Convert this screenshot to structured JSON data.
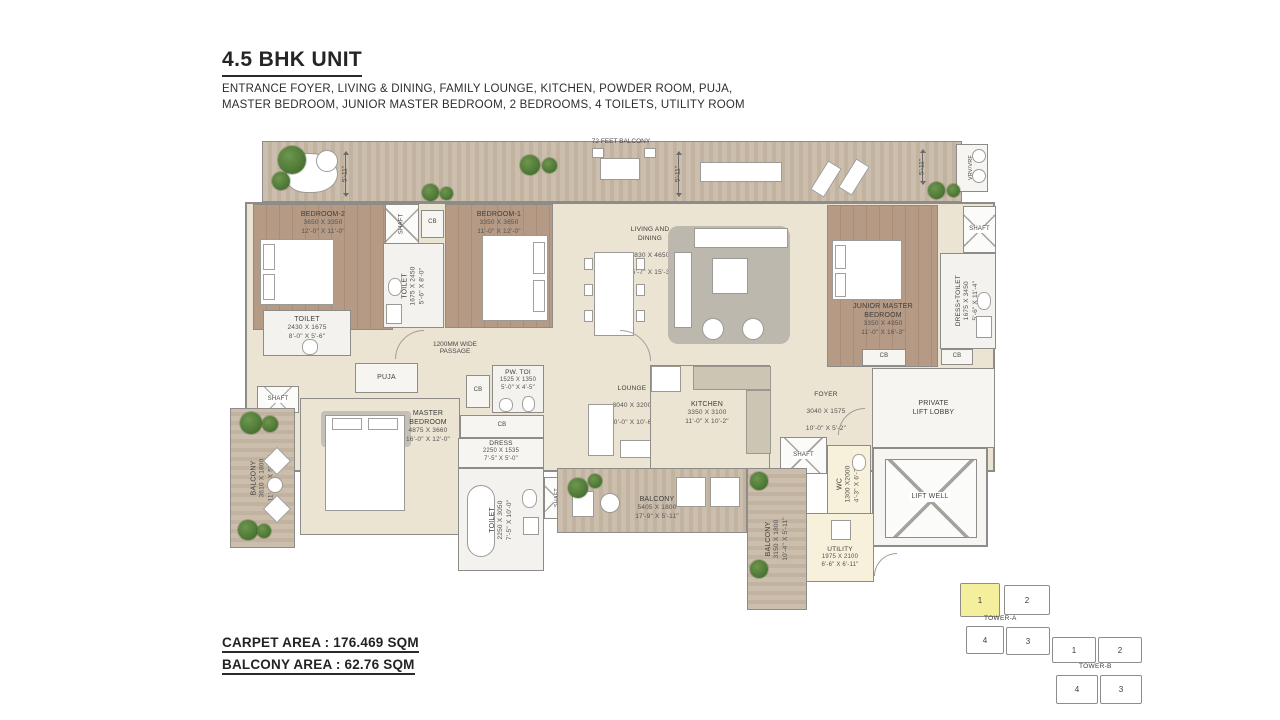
{
  "header": {
    "title": "4.5 BHK UNIT",
    "subtitle": "ENTRANCE FOYER, LIVING & DINING, FAMILY LOUNGE, KITCHEN, POWDER ROOM, PUJA,\nMASTER BEDROOM, JUNIOR MASTER BEDROOM, 2 BEDROOMS, 4 TOILETS, UTILITY ROOM"
  },
  "areas": {
    "carpet_label": "CARPET AREA : 176.469 SQM",
    "balcony_label": "BALCONY AREA : 62.76 SQM"
  },
  "plan": {
    "labels": {
      "shaft": "SHAFT",
      "cb": "CB",
      "puja": "PUJA",
      "vrv": "VRV/VRF",
      "lift_well": "LIFT WELL",
      "private_lift_lobby": "PRIVATE\nLIFT LOBBY",
      "balcony_72": "72 FEET BALCONY",
      "passage": "1200MM WIDE\nPASSAGE",
      "dim_5_11": "5'-11\""
    },
    "rooms": {
      "bedroom2": {
        "name": "BEDROOM-2",
        "mm": "3650 X 3350",
        "ft": "12'-0\" X 11'-0\""
      },
      "bedroom1": {
        "name": "BEDROOM-1",
        "mm": "3350 X 3650",
        "ft": "11'-0\" X 12'-0\""
      },
      "toilet_mid": {
        "name": "TOILET",
        "mm": "1675 X 2450",
        "ft": "5'-6\" X 8'-0\""
      },
      "toilet_left": {
        "name": "TOILET",
        "mm": "2430 X 1675",
        "ft": "8'-0\" X 5'-6\""
      },
      "living_dining": {
        "name": "LIVING AND\nDINING",
        "mm": "7830 X 4650",
        "ft": "25'-7\" X 15'-3\""
      },
      "junior_master": {
        "name": "JUNIOR MASTER\nBEDROOM",
        "mm": "3350 X 4950",
        "ft": "11'-0\" X 16'-3\""
      },
      "dress_toilet": {
        "name": "DRESS+TOILET",
        "mm": "1675 X 3450",
        "ft": "5'-6\" X 11'-4\""
      },
      "master": {
        "name": "MASTER\nBEDROOM",
        "mm": "4875 X 3660",
        "ft": "16'-0\" X 12'-0\""
      },
      "pw_toi": {
        "name": "PW. TOI",
        "mm": "1525 X 1350",
        "ft": "5'-0\" X 4'-5\""
      },
      "dress": {
        "name": "DRESS",
        "mm": "2250 X 1535",
        "ft": "7'-5\" X 5'-0\""
      },
      "toilet_master": {
        "name": "TOILET",
        "mm": "2250 X 3050",
        "ft": "7'-5\" X 10'-0\""
      },
      "lounge": {
        "name": "LOUNGE",
        "mm": "3040 X 3200",
        "ft": "10'-0\" X 10'-6\""
      },
      "kitchen": {
        "name": "KITCHEN",
        "mm": "3350 X 3100",
        "ft": "11'-0\" X 10'-2\""
      },
      "foyer": {
        "name": "FOYER",
        "mm": "3040 X 1575",
        "ft": "10'-0\" X 5'-2\""
      },
      "wc": {
        "name": "WC",
        "mm": "1300 X2000",
        "ft": "4'-3\" X 6'-7\""
      },
      "utility": {
        "name": "UTILITY",
        "mm": "1975 X 2100",
        "ft": "6'-6\" X 6'-11\""
      },
      "balcony_left": {
        "name": "BALCONY",
        "mm": "3610 X 1800",
        "ft": "11'-10\" X 5'-11\""
      },
      "balcony_bottom": {
        "name": "BALCONY",
        "mm": "5405 X 1800",
        "ft": "17'-9\" X 5'-11\""
      },
      "balcony_right": {
        "name": "BALCONY",
        "mm": "3150 X 1800",
        "ft": "10'-4\" X 5'-11\""
      }
    }
  },
  "keyplan": {
    "tower_a_label": "TOWER-A",
    "tower_b_label": "TOWER-B",
    "highlight_color": "#f4ef9c",
    "tower_a_units": {
      "u1": "1",
      "u2": "2",
      "u3": "3",
      "u4": "4"
    },
    "tower_b_units": {
      "u1": "1",
      "u2": "2",
      "u3": "3",
      "u4": "4"
    }
  }
}
